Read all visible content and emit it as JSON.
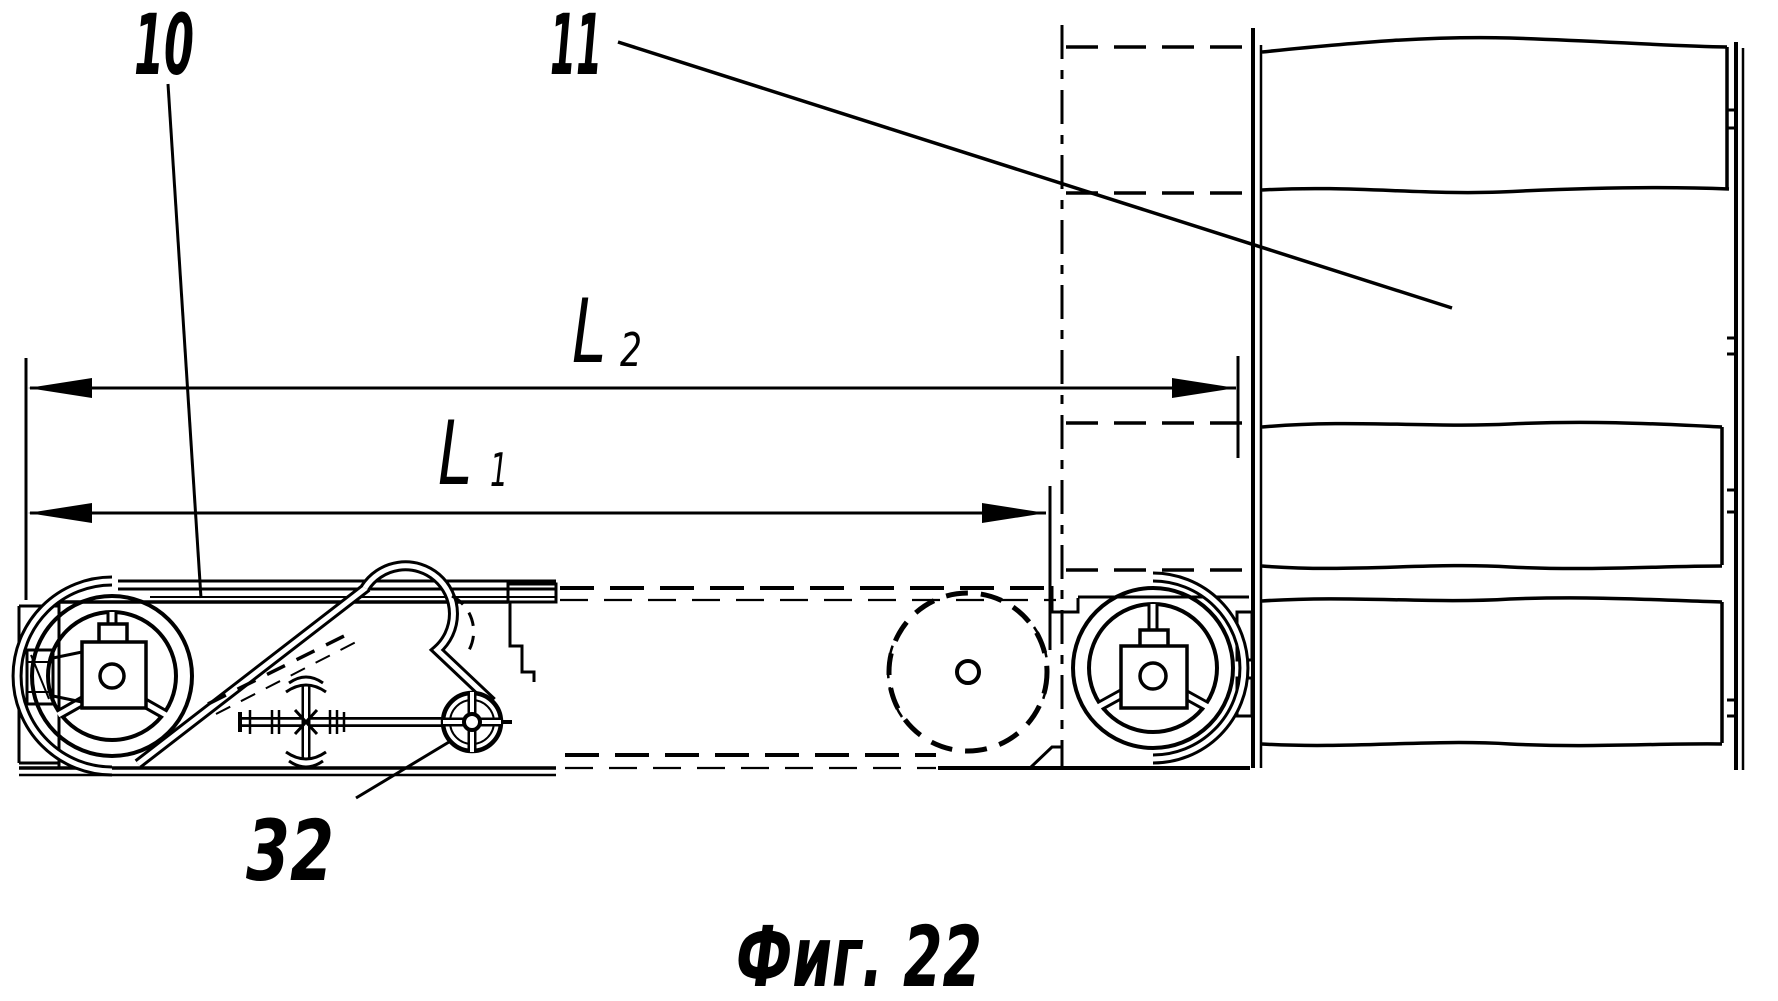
{
  "figure": {
    "caption": "Фиг. 22",
    "type_note": "patent line drawing",
    "colors": {
      "ink": "#000000",
      "paper": "#ffffff"
    }
  },
  "labels": {
    "r10": "10",
    "r11": "11",
    "r32": "32"
  },
  "dimensions": {
    "l2": {
      "letter": "L",
      "subscript": "2"
    },
    "l1": {
      "letter": "L",
      "subscript": "1"
    }
  }
}
